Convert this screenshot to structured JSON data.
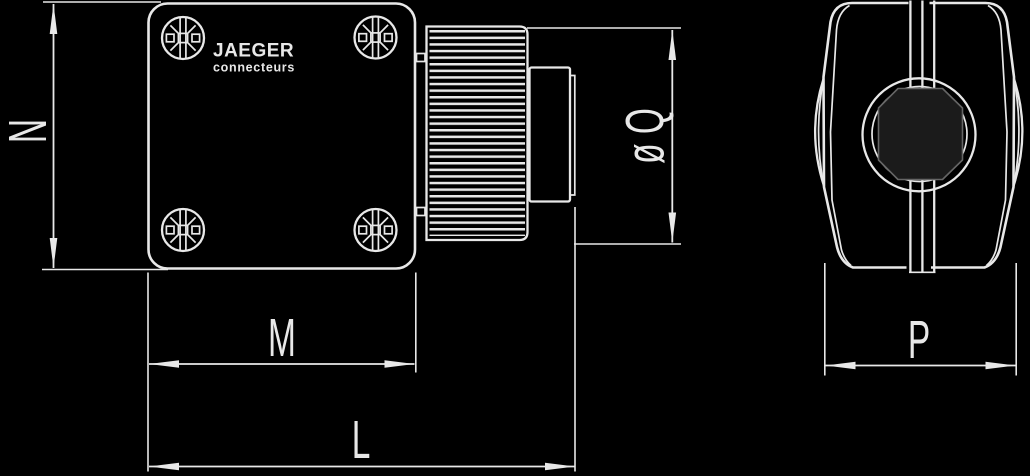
{
  "brand": {
    "name": "JAEGER",
    "subtitle": "connecteurs"
  },
  "dimension_labels": {
    "height": "N",
    "flange_width": "M",
    "overall_length": "L",
    "nut_diameter": "ø Q",
    "profile_width": "P"
  },
  "colors": {
    "background": "#000000",
    "line": "#e8e8e8",
    "insert_fill": "#1b1b1b"
  }
}
